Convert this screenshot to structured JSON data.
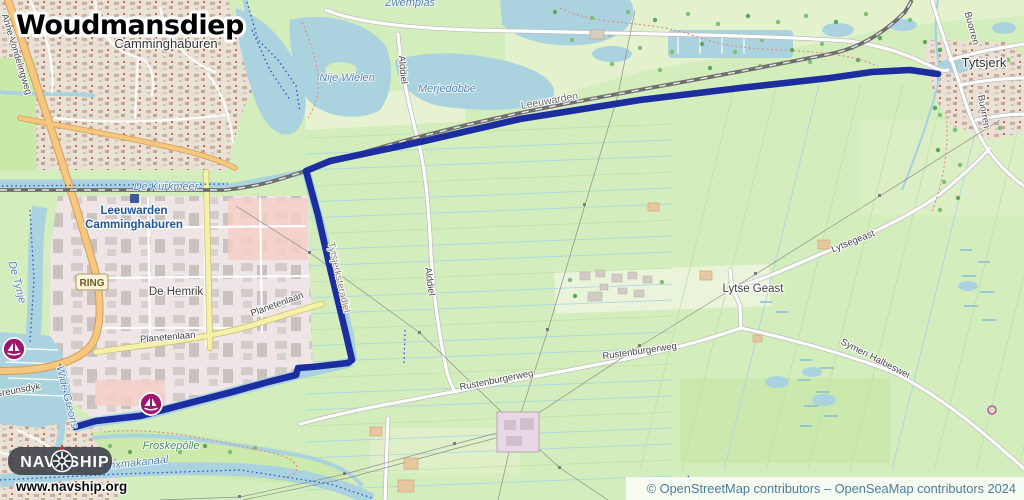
{
  "title": "Woudmansdiep",
  "logo": {
    "nav": "NAV",
    "ship": "SHIP",
    "url": "www.navship.org"
  },
  "attribution": "© OpenStreetMap contributors – OpenSeaMap contributors 2024",
  "ring_badge": "RING",
  "colors": {
    "route": "#1c2da0",
    "water": "#aad3df",
    "land": "#d3edbc",
    "marina": "#a0146e",
    "attribution_text": "#4a7d9f"
  },
  "route": {
    "name": "Woudmansdiep route",
    "width": 6.6,
    "points": [
      [
        75,
        427
      ],
      [
        96,
        421
      ],
      [
        140,
        416
      ],
      [
        178,
        406
      ],
      [
        232,
        392
      ],
      [
        268,
        382
      ],
      [
        296,
        375
      ],
      [
        298,
        368
      ],
      [
        312,
        367
      ],
      [
        348,
        363
      ],
      [
        352,
        360
      ],
      [
        345,
        330
      ],
      [
        330,
        268
      ],
      [
        318,
        215
      ],
      [
        308,
        178
      ],
      [
        306,
        171
      ],
      [
        330,
        161
      ],
      [
        420,
        142
      ],
      [
        520,
        119
      ],
      [
        640,
        100
      ],
      [
        740,
        88
      ],
      [
        830,
        78
      ],
      [
        872,
        72
      ],
      [
        910,
        70
      ],
      [
        938,
        74
      ]
    ]
  },
  "map": {
    "labels": [
      {
        "text": "Camminghaburen",
        "x": 166,
        "y": 48,
        "cls": "place"
      },
      {
        "text": "Tytsjerk",
        "x": 984,
        "y": 67,
        "cls": "place"
      },
      {
        "text": "Lytse Geast",
        "x": 753,
        "y": 292,
        "cls": "place-sm"
      },
      {
        "text": "De Hemrik",
        "x": 176,
        "y": 295,
        "cls": "place-sm"
      },
      {
        "text": "Leeuwarden",
        "x": 550,
        "y": 104,
        "rot": -10,
        "cls": "rail"
      },
      {
        "text": "Leeuwarden",
        "x": 134,
        "y": 214,
        "cls": "station"
      },
      {
        "text": "Camminghaburen",
        "x": 134,
        "y": 228,
        "cls": "station"
      },
      {
        "text": "Nije Wielen",
        "x": 347,
        "y": 81,
        "cls": "water"
      },
      {
        "text": "Merjedobbe",
        "x": 447,
        "y": 92,
        "cls": "water"
      },
      {
        "text": "De Kúrkmeer",
        "x": 166,
        "y": 190,
        "cls": "water"
      },
      {
        "text": "Zwemplas",
        "x": 410,
        "y": 6,
        "cls": "water"
      },
      {
        "text": "Van Harinxmakanaal",
        "x": 118,
        "y": 468,
        "rot": -6,
        "cls": "water"
      },
      {
        "text": "Wide Greons",
        "x": 64,
        "y": 398,
        "rot": 76,
        "cls": "water"
      },
      {
        "text": "De Tynje",
        "x": 14,
        "y": 283,
        "rot": 75,
        "cls": "water"
      },
      {
        "text": "Froskepôlle",
        "x": 171,
        "y": 449,
        "cls": "green-label"
      },
      {
        "text": "Tytsjerksteradiel",
        "x": 336,
        "y": 278,
        "rot": 77,
        "cls": "admin"
      },
      {
        "text": "Alddiel",
        "x": 400,
        "y": 70,
        "rot": 85,
        "cls": "road"
      },
      {
        "text": "Alddiel",
        "x": 427,
        "y": 282,
        "rot": 82,
        "cls": "road"
      },
      {
        "text": "Buorren",
        "x": 969,
        "y": 29,
        "rot": 75,
        "cls": "road"
      },
      {
        "text": "Buorren",
        "x": 981,
        "y": 112,
        "rot": 80,
        "cls": "road"
      },
      {
        "text": "Planetenlaan",
        "x": 168,
        "y": 340,
        "rot": -5,
        "cls": "road"
      },
      {
        "text": "Planetenlaan",
        "x": 278,
        "y": 307,
        "rot": -20,
        "cls": "road"
      },
      {
        "text": "Rustenburgerweg",
        "x": 640,
        "y": 354,
        "rot": -8,
        "cls": "road"
      },
      {
        "text": "Rustenburgerweg",
        "x": 497,
        "y": 383,
        "rot": -11,
        "cls": "road"
      },
      {
        "text": "Symen Halbeswei",
        "x": 874,
        "y": 361,
        "rot": 27,
        "cls": "road"
      },
      {
        "text": "Lytsegeast",
        "x": 854,
        "y": 244,
        "rot": -22,
        "cls": "road"
      },
      {
        "text": "Anne Vondelingweg",
        "x": 14,
        "y": 55,
        "rot": 73,
        "cls": "road"
      },
      {
        "text": "Greunsdyk",
        "x": 18,
        "y": 393,
        "rot": -10,
        "cls": "road"
      }
    ],
    "marina_icons": [
      {
        "x": 14,
        "y": 349
      },
      {
        "x": 151,
        "y": 404
      }
    ],
    "station_marker": {
      "x": 130,
      "y": 194
    },
    "slipway_icon": {
      "x": 992,
      "y": 410
    }
  }
}
